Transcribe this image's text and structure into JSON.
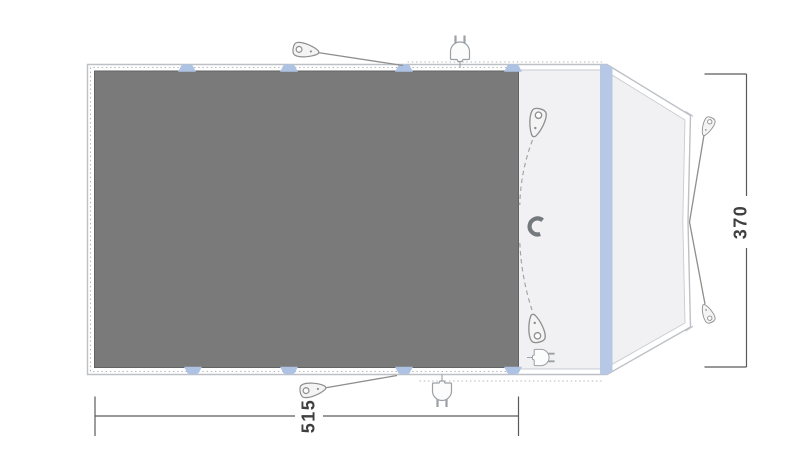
{
  "floorplan": {
    "view": "tent-awning-top-view-floorplan",
    "dimension_width": {
      "value": "515"
    },
    "dimension_depth": {
      "value": "370"
    },
    "colors": {
      "groundsheet_fill": "#7a7a7a",
      "groundsheet_border": "#636363",
      "canopy_fill": "#f1f1f3",
      "outline_gray": "#bdc0c5",
      "pole_sleeve_blue": "#b6c8e6",
      "attachment_tab_blue": "#aec3e4",
      "guyline_gray": "#8e8e8e",
      "dimension_gray": "#5a5a5a",
      "label_text": "#3f3f3f"
    },
    "icons": [
      {
        "name": "guy-peg-top-icon"
      },
      {
        "name": "guy-peg-bottom-icon"
      },
      {
        "name": "inner-peg-top-icon"
      },
      {
        "name": "inner-peg-bottom-icon"
      },
      {
        "name": "guy-peg-right-top-icon"
      },
      {
        "name": "guy-peg-right-bottom-icon"
      },
      {
        "name": "power-plug-top-icon"
      },
      {
        "name": "power-plug-bottom-icon"
      },
      {
        "name": "magnet-icon"
      }
    ]
  }
}
